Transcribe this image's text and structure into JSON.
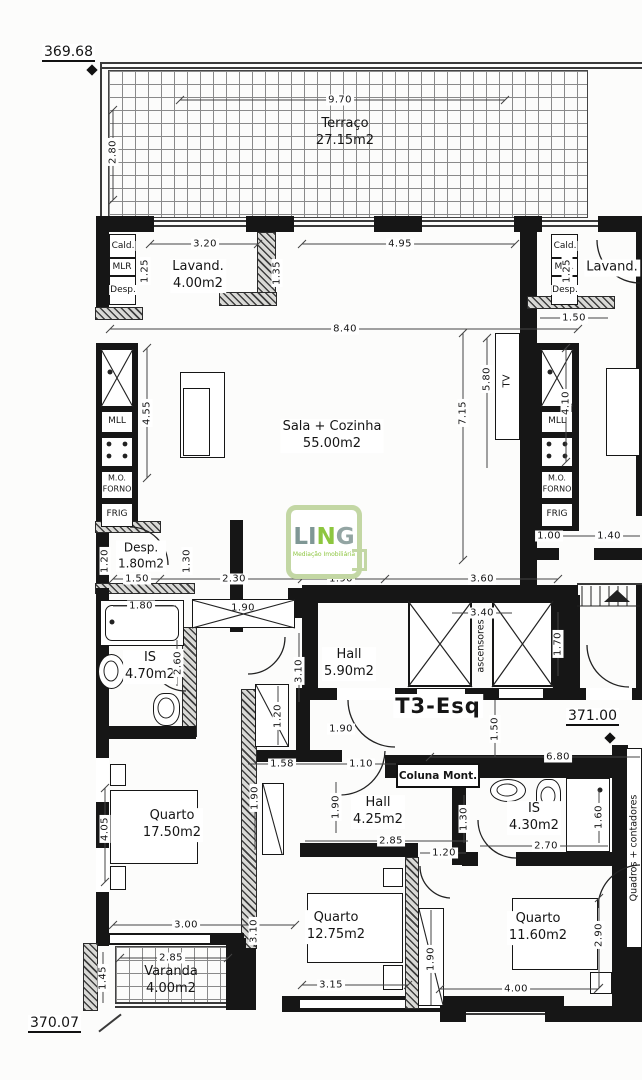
{
  "plan": {
    "unit": "T3-Esq",
    "elevations": {
      "upper": "369.68",
      "mid": "371.00",
      "lower": "370.07"
    },
    "rooms": {
      "terraco": {
        "name": "Terraço",
        "area": "27.15m2"
      },
      "lavand_left": {
        "name": "Lavand.",
        "area": "4.00m2"
      },
      "lavand_right": {
        "name": "Lavand.",
        "area": ""
      },
      "sala": {
        "name": "Sala + Cozinha",
        "area": "55.00m2"
      },
      "desp_small": {
        "name": "Desp.",
        "area": "1.80m2"
      },
      "is_main": {
        "name": "IS",
        "area": "4.70m2"
      },
      "hall_main": {
        "name": "Hall",
        "area": "5.90m2"
      },
      "hall_small": {
        "name": "Hall",
        "area": "4.25m2"
      },
      "is_small": {
        "name": "IS",
        "area": "4.30m2"
      },
      "quarto_1": {
        "name": "Quarto",
        "area": "17.50m2"
      },
      "quarto_2": {
        "name": "Quarto",
        "area": "12.75m2"
      },
      "quarto_3": {
        "name": "Quarto",
        "area": "11.60m2"
      },
      "varanda": {
        "name": "Varanda",
        "area": "4.00m2"
      }
    },
    "labels": {
      "cald": "Cald.",
      "mlr": "MLR",
      "desp": "Desp.",
      "mll": "MLL",
      "mo": "M.O.",
      "forno": "FORNO",
      "frig": "FRIG",
      "tv": "TV",
      "ascensores": "ascensores",
      "coluna": "Coluna Mont.",
      "quadros": "Quadros + contadores"
    },
    "dims": [
      "9.70",
      "2.80",
      "3.20",
      "1.25",
      "1.35",
      "4.95",
      "1.25",
      "1.50",
      "8.40",
      "4.55",
      "7.15",
      "5.80",
      "4.10",
      "1.00",
      "1.40",
      "1.20",
      "1.30",
      "1.50",
      "2.30",
      "1.90",
      "3.60",
      "1.80",
      "1.90",
      "3.40",
      "2.60",
      "3.10",
      "1.70",
      "1.20",
      "1.90",
      "1.50",
      "6.80",
      "1.58",
      "1.10",
      "1.90",
      "1.30",
      "1.60",
      "4.05",
      "1.90",
      "2.85",
      "1.20",
      "2.70",
      "3.00",
      "3.10",
      "2.90",
      "2.85",
      "1.45",
      "1.90",
      "3.15",
      "4.00"
    ],
    "logo": {
      "brand_l1": "LI",
      "brand_l2": "N",
      "brand_l3": "G",
      "tagline": "Mediação Imobiliária",
      "green": "#8dc63f",
      "gray": "#7f9795",
      "border": "#c3d7a4"
    }
  }
}
